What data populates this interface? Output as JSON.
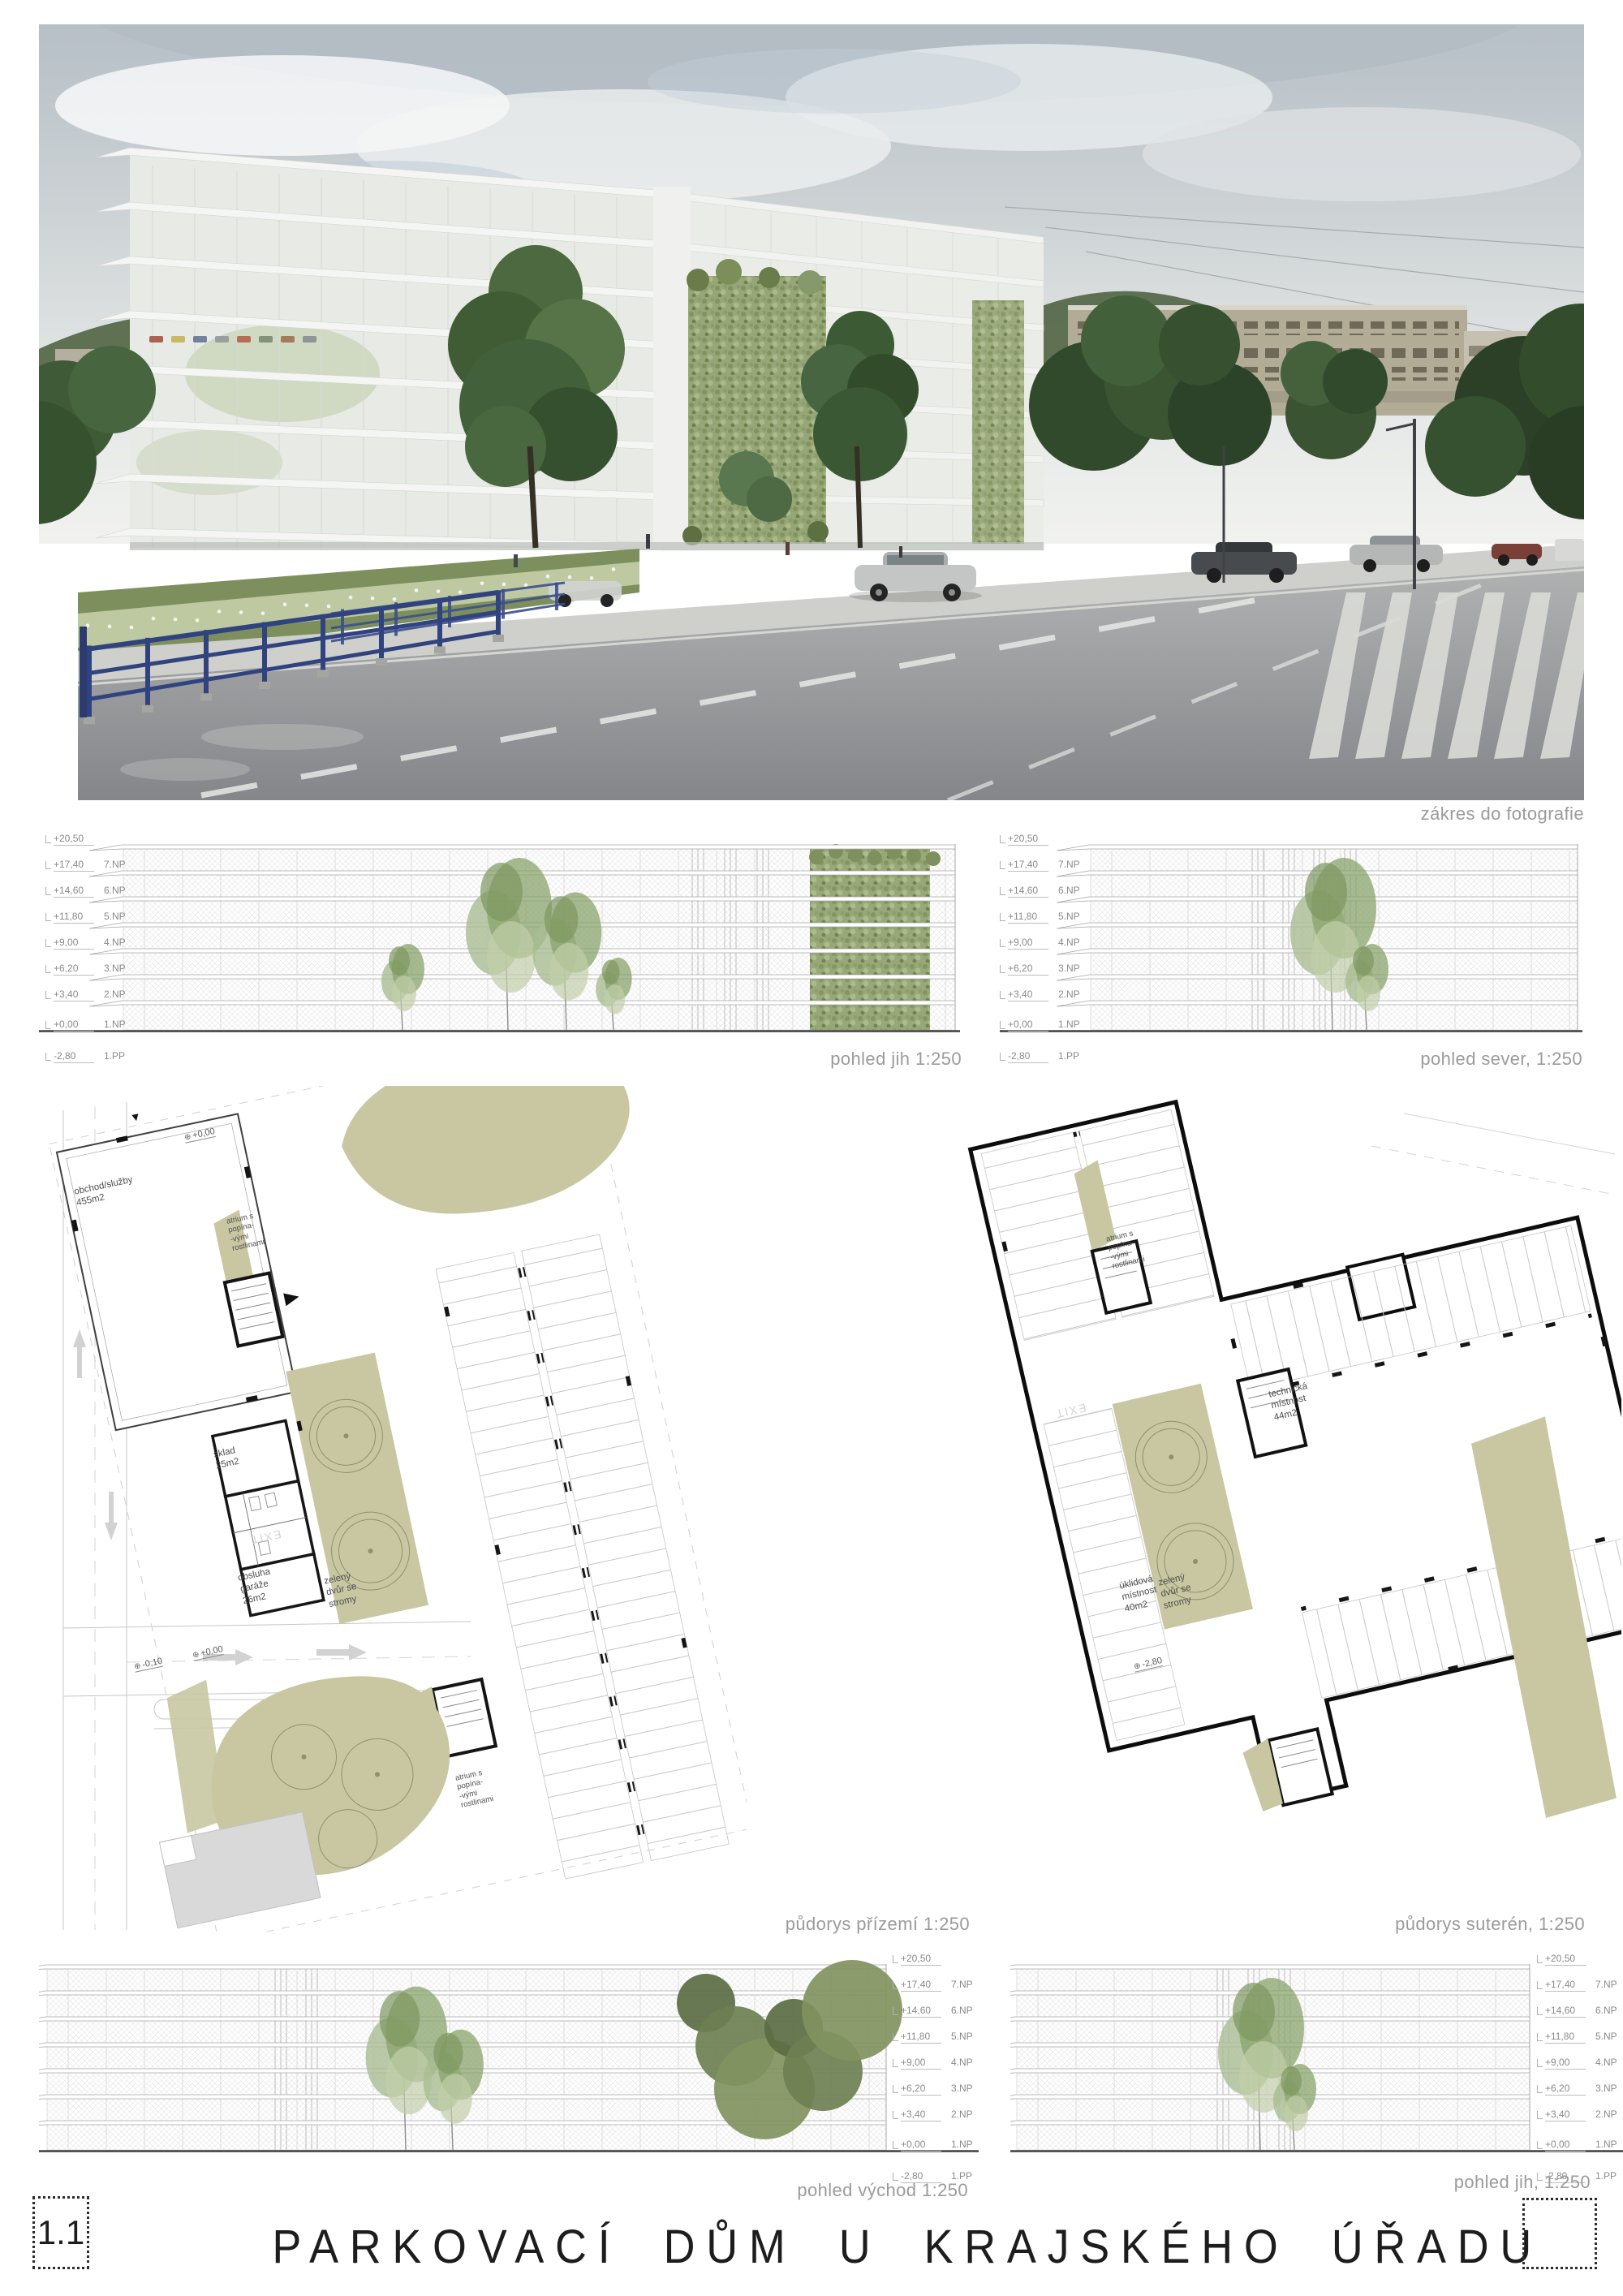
{
  "sheet": {
    "number": "1.1",
    "title": "PARKOVACÍ DŮM U KRAJSKÉHO ÚŘADU"
  },
  "photo": {
    "caption": "zákres do fotografie"
  },
  "levels": [
    {
      "elev": "+20,50",
      "floor": ""
    },
    {
      "elev": "+17,40",
      "floor": "7.NP"
    },
    {
      "elev": "+14,60",
      "floor": "6.NP"
    },
    {
      "elev": "+11,80",
      "floor": "5.NP"
    },
    {
      "elev": "+9,00",
      "floor": "4.NP"
    },
    {
      "elev": "+6,20",
      "floor": "3.NP"
    },
    {
      "elev": "+3,40",
      "floor": "2.NP"
    },
    {
      "elev": "+0,00",
      "floor": "1.NP"
    },
    {
      "elev": "-2,80",
      "floor": "1.PP"
    }
  ],
  "elevations": {
    "south_top": {
      "caption": "pohled jih 1:250"
    },
    "north_top": {
      "caption": "pohled sever, 1:250"
    },
    "east_bottom": {
      "caption": "pohled východ 1:250"
    },
    "south_bottom": {
      "caption": "pohled jih, 1:250"
    }
  },
  "plans": {
    "ground": {
      "caption": "půdorys přízemí 1:250",
      "labels": {
        "shop": "obchod/služby\n455m2",
        "atrium": "atrium s\npopína-\n-vými\nrostlinami",
        "storage": "sklad\n25m2",
        "garage_service": "obsluha\ngaráže\n26m2",
        "courtyard": "zelený\ndvůr se\nstromy",
        "exit": "EXIT",
        "level_zero": "+0,00",
        "level_minus": "-0,10"
      }
    },
    "basement": {
      "caption": "půdorys suterén, 1:250",
      "labels": {
        "tech_room": "technická\nmístnost\n44m2",
        "cleaning_room": "úklidová\nmístnost\n40m2",
        "courtyard": "zelený\ndvůr se\nstromy",
        "atrium": "atrium s\npopína-\n-vými\nrostlinami",
        "exit": "EXIT",
        "level": "-2,80"
      }
    }
  },
  "colors": {
    "plan_green": "#c8c7a2",
    "fence_blue": "#31437f",
    "wall_black": "#111111"
  }
}
